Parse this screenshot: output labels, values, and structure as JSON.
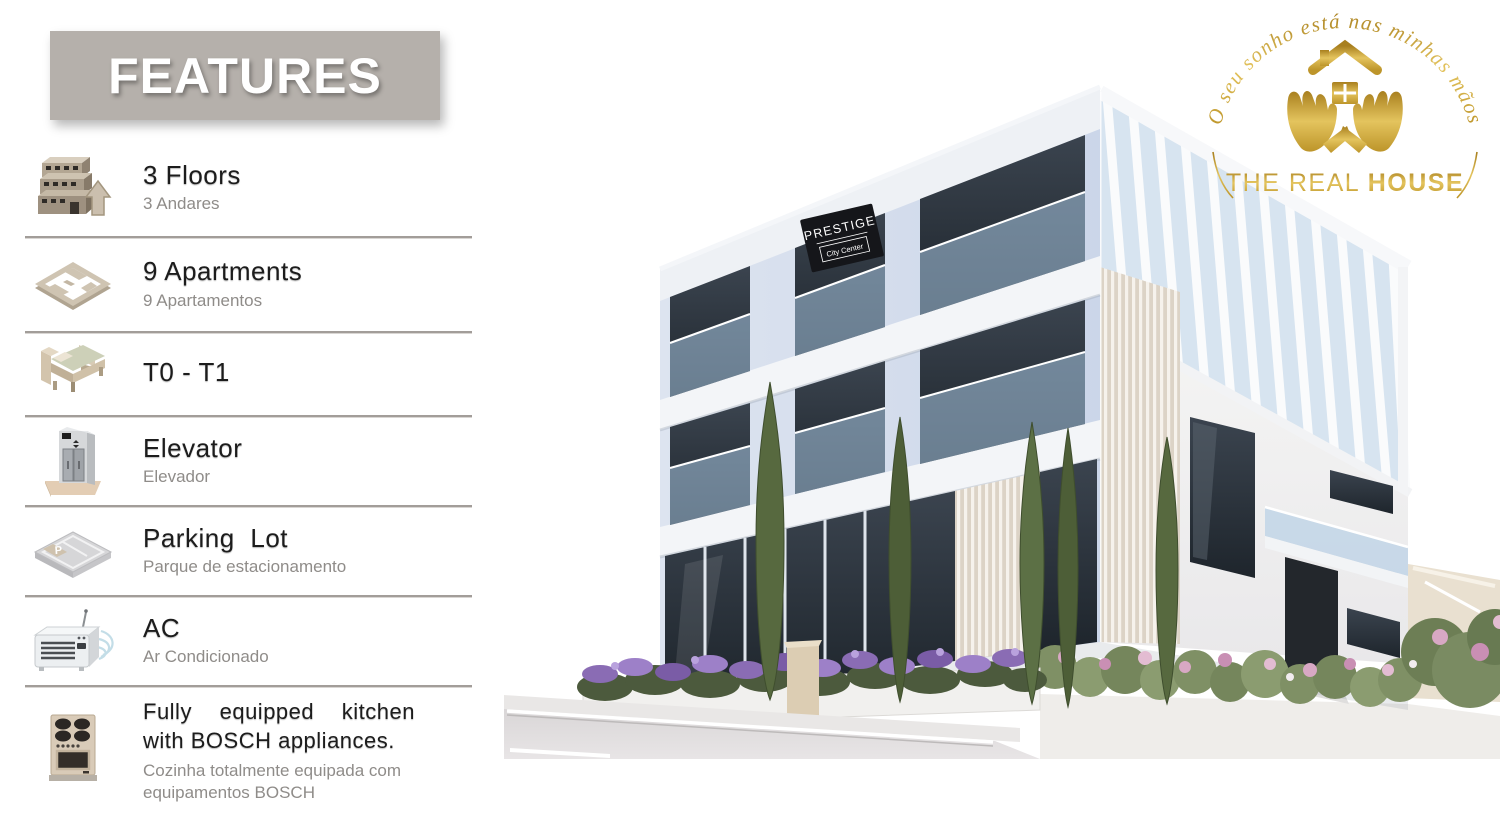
{
  "header": {
    "title": "FEATURES",
    "bg_color": "#b5b0ab"
  },
  "features": {
    "items": [
      {
        "title": "3 Floors",
        "subtitle": "3 Andares",
        "icon": "building-floors-icon"
      },
      {
        "title": "9 Apartments",
        "subtitle": "9 Apartamentos",
        "icon": "floorplan-icon"
      },
      {
        "title": "T0 - T1",
        "subtitle": "",
        "icon": "bed-icon"
      },
      {
        "title": "Elevator",
        "subtitle": "Elevador",
        "icon": "elevator-icon"
      },
      {
        "title": "Parking Lot",
        "subtitle": "Parque de estacionamento",
        "icon": "parking-icon"
      },
      {
        "title": "AC",
        "subtitle": "Ar Condicionado",
        "icon": "ac-icon"
      },
      {
        "title": "Fully equipped kitchen with BOSCH appliances.",
        "subtitle": "Cozinha totalmente equipada com equipamentos BOSCH",
        "icon": "stove-icon"
      }
    ],
    "divider_color": "#a29d99",
    "title_color": "#1c1c1c",
    "subtitle_color": "#8f8c89"
  },
  "logo": {
    "tagline": "O seu sonho está nas minhas mãos",
    "title_regular": "THE REAL ",
    "title_bold": "HOUSE",
    "gold_color": "#c9a227"
  },
  "building": {
    "sign_line1": "PRESTIGE",
    "sign_line2": "City Center",
    "accent_glass": "#2b333d",
    "accent_rail": "#a9c8e4",
    "flower_purple": "#8a6cb4",
    "flower_pink": "#d8a8c4"
  }
}
